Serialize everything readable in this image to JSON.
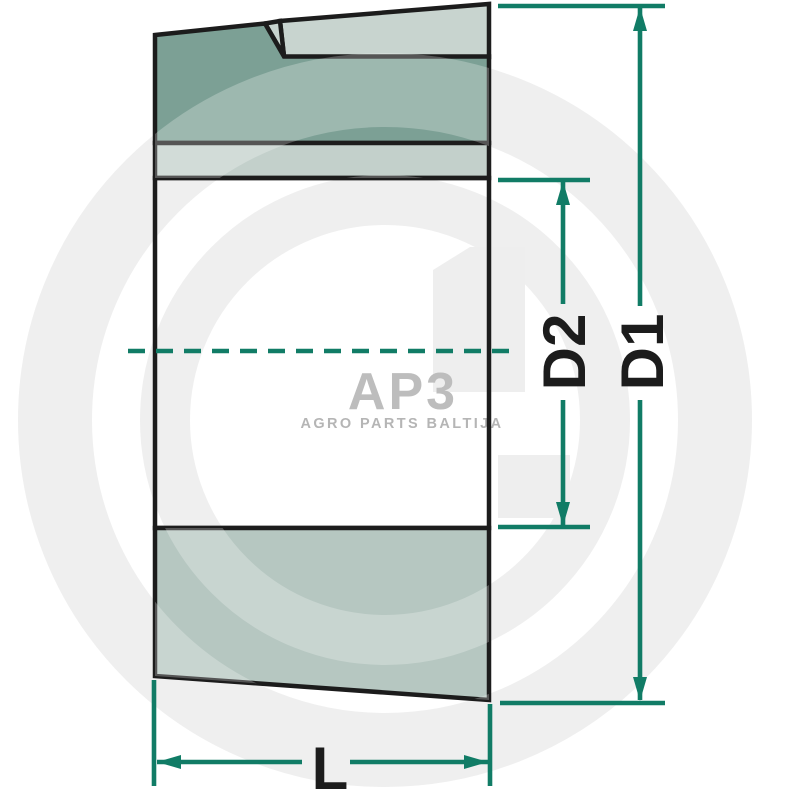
{
  "drawing": {
    "type": "technical-section-view",
    "subject": "tapered clamping bushing cross-section",
    "labels": {
      "d1": "D1",
      "d2": "D2",
      "length": "L"
    },
    "dimensions": [
      {
        "id": "d1",
        "label": "D1",
        "meaning": "outer diameter (large end)"
      },
      {
        "id": "d2",
        "label": "D2",
        "meaning": "bore diameter"
      },
      {
        "id": "length",
        "label": "L",
        "meaning": "overall length"
      }
    ],
    "colors": {
      "dimension_teal": "#117c66",
      "outline_black": "#1c1c1c",
      "section_dark_sage": "#7ca095",
      "section_light_sage": "#c3d0cb",
      "section_top_light": "#c8d4cf",
      "section_bottom_sage": "#b6c7c1",
      "label_black": "#1c1c1c"
    }
  },
  "watermark": {
    "logo": "AP3",
    "tagline": "AGRO PARTS BALTIJA",
    "color": "#bdbdbd",
    "ring_gray": "#efefef"
  }
}
